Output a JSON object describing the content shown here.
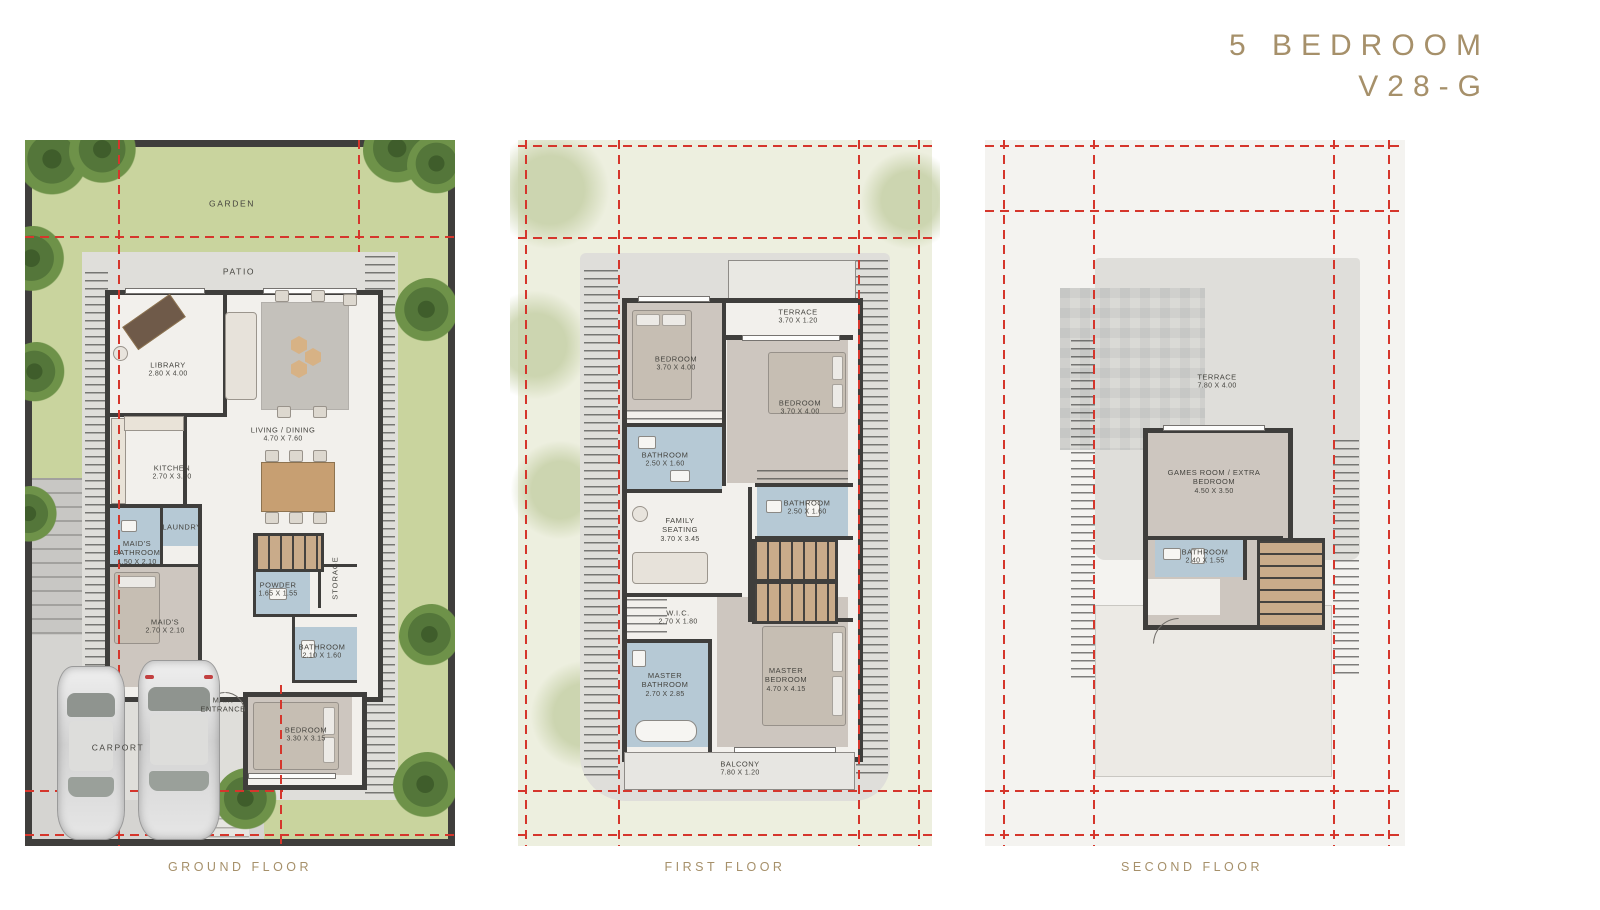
{
  "title": {
    "line1": "5 BEDROOM",
    "line2": "V28-G"
  },
  "colors": {
    "accent": "#a6906a",
    "red": "#d5362c",
    "wall": "#3f3e3c",
    "label": "#45443f",
    "garden": "#c9d49e",
    "tree_dark": "#3f5d2b",
    "tree_light": "#6e9249",
    "slab": "#dfdeda",
    "marble": "#f2f0ec",
    "bath": "#b6c9d5",
    "bedfloor": "#cdc6bf",
    "panel1": "#edefdf",
    "panel2": "#f4f3f0",
    "stair": "#c9ab8a",
    "drive": "#d5d4d1",
    "wood": "#c79f72"
  },
  "floors": {
    "ground": {
      "caption": "GROUND FLOOR",
      "rooms": {
        "garden": {
          "name": "GARDEN"
        },
        "patio": {
          "name": "PATIO"
        },
        "library": {
          "name": "LIBRARY",
          "dims": "2.80 X 4.00"
        },
        "living_dining": {
          "name": "LIVING / DINING",
          "dims": "4.70 X 7.60"
        },
        "kitchen": {
          "name": "KITCHEN",
          "dims": "2.70 X 3.50"
        },
        "maids_bathroom": {
          "name": "MAID'S BATHROOM",
          "dims": "1.50 X 2.10"
        },
        "laundry": {
          "name": "LAUNDRY"
        },
        "maids": {
          "name": "MAID'S",
          "dims": "2.70 X 2.10"
        },
        "powder": {
          "name": "POWDER",
          "dims": "1.65 X 1.55"
        },
        "storage": {
          "name": "STORAGE"
        },
        "bathroom": {
          "name": "BATHROOM",
          "dims": "2.10 X 1.60"
        },
        "main_entrance": {
          "name": "MAIN ENTRANCE"
        },
        "bedroom": {
          "name": "BEDROOM",
          "dims": "3.30 X 3.15"
        },
        "carport": {
          "name": "CARPORT"
        }
      }
    },
    "first": {
      "caption": "FIRST FLOOR",
      "rooms": {
        "terrace": {
          "name": "TERRACE",
          "dims": "3.70 X 1.20"
        },
        "bedroom_left": {
          "name": "BEDROOM",
          "dims": "3.70 X 4.00"
        },
        "bedroom_right": {
          "name": "BEDROOM",
          "dims": "3.70 X 4.00"
        },
        "bathroom_left": {
          "name": "BATHROOM",
          "dims": "2.50 X 1.60"
        },
        "bathroom_right": {
          "name": "BATHROOM",
          "dims": "2.50 X 1.60"
        },
        "family_seating": {
          "name": "FAMILY SEATING",
          "dims": "3.70 X 3.45"
        },
        "wic": {
          "name": "W.I.C.",
          "dims": "2.70 X 1.80"
        },
        "master_bathroom": {
          "name": "MASTER BATHROOM",
          "dims": "2.70 X 2.85"
        },
        "master_bedroom": {
          "name": "MASTER BEDROOM",
          "dims": "4.70 X 4.15"
        },
        "balcony": {
          "name": "BALCONY",
          "dims": "7.80 X 1.20"
        }
      }
    },
    "second": {
      "caption": "SECOND FLOOR",
      "rooms": {
        "terrace": {
          "name": "TERRACE",
          "dims": "7.80 X 4.00"
        },
        "games_room": {
          "name": "GAMES ROOM / EXTRA BEDROOM",
          "dims": "4.50 X 3.50"
        },
        "bathroom": {
          "name": "BATHROOM",
          "dims": "2.40 X 1.55"
        }
      }
    }
  }
}
